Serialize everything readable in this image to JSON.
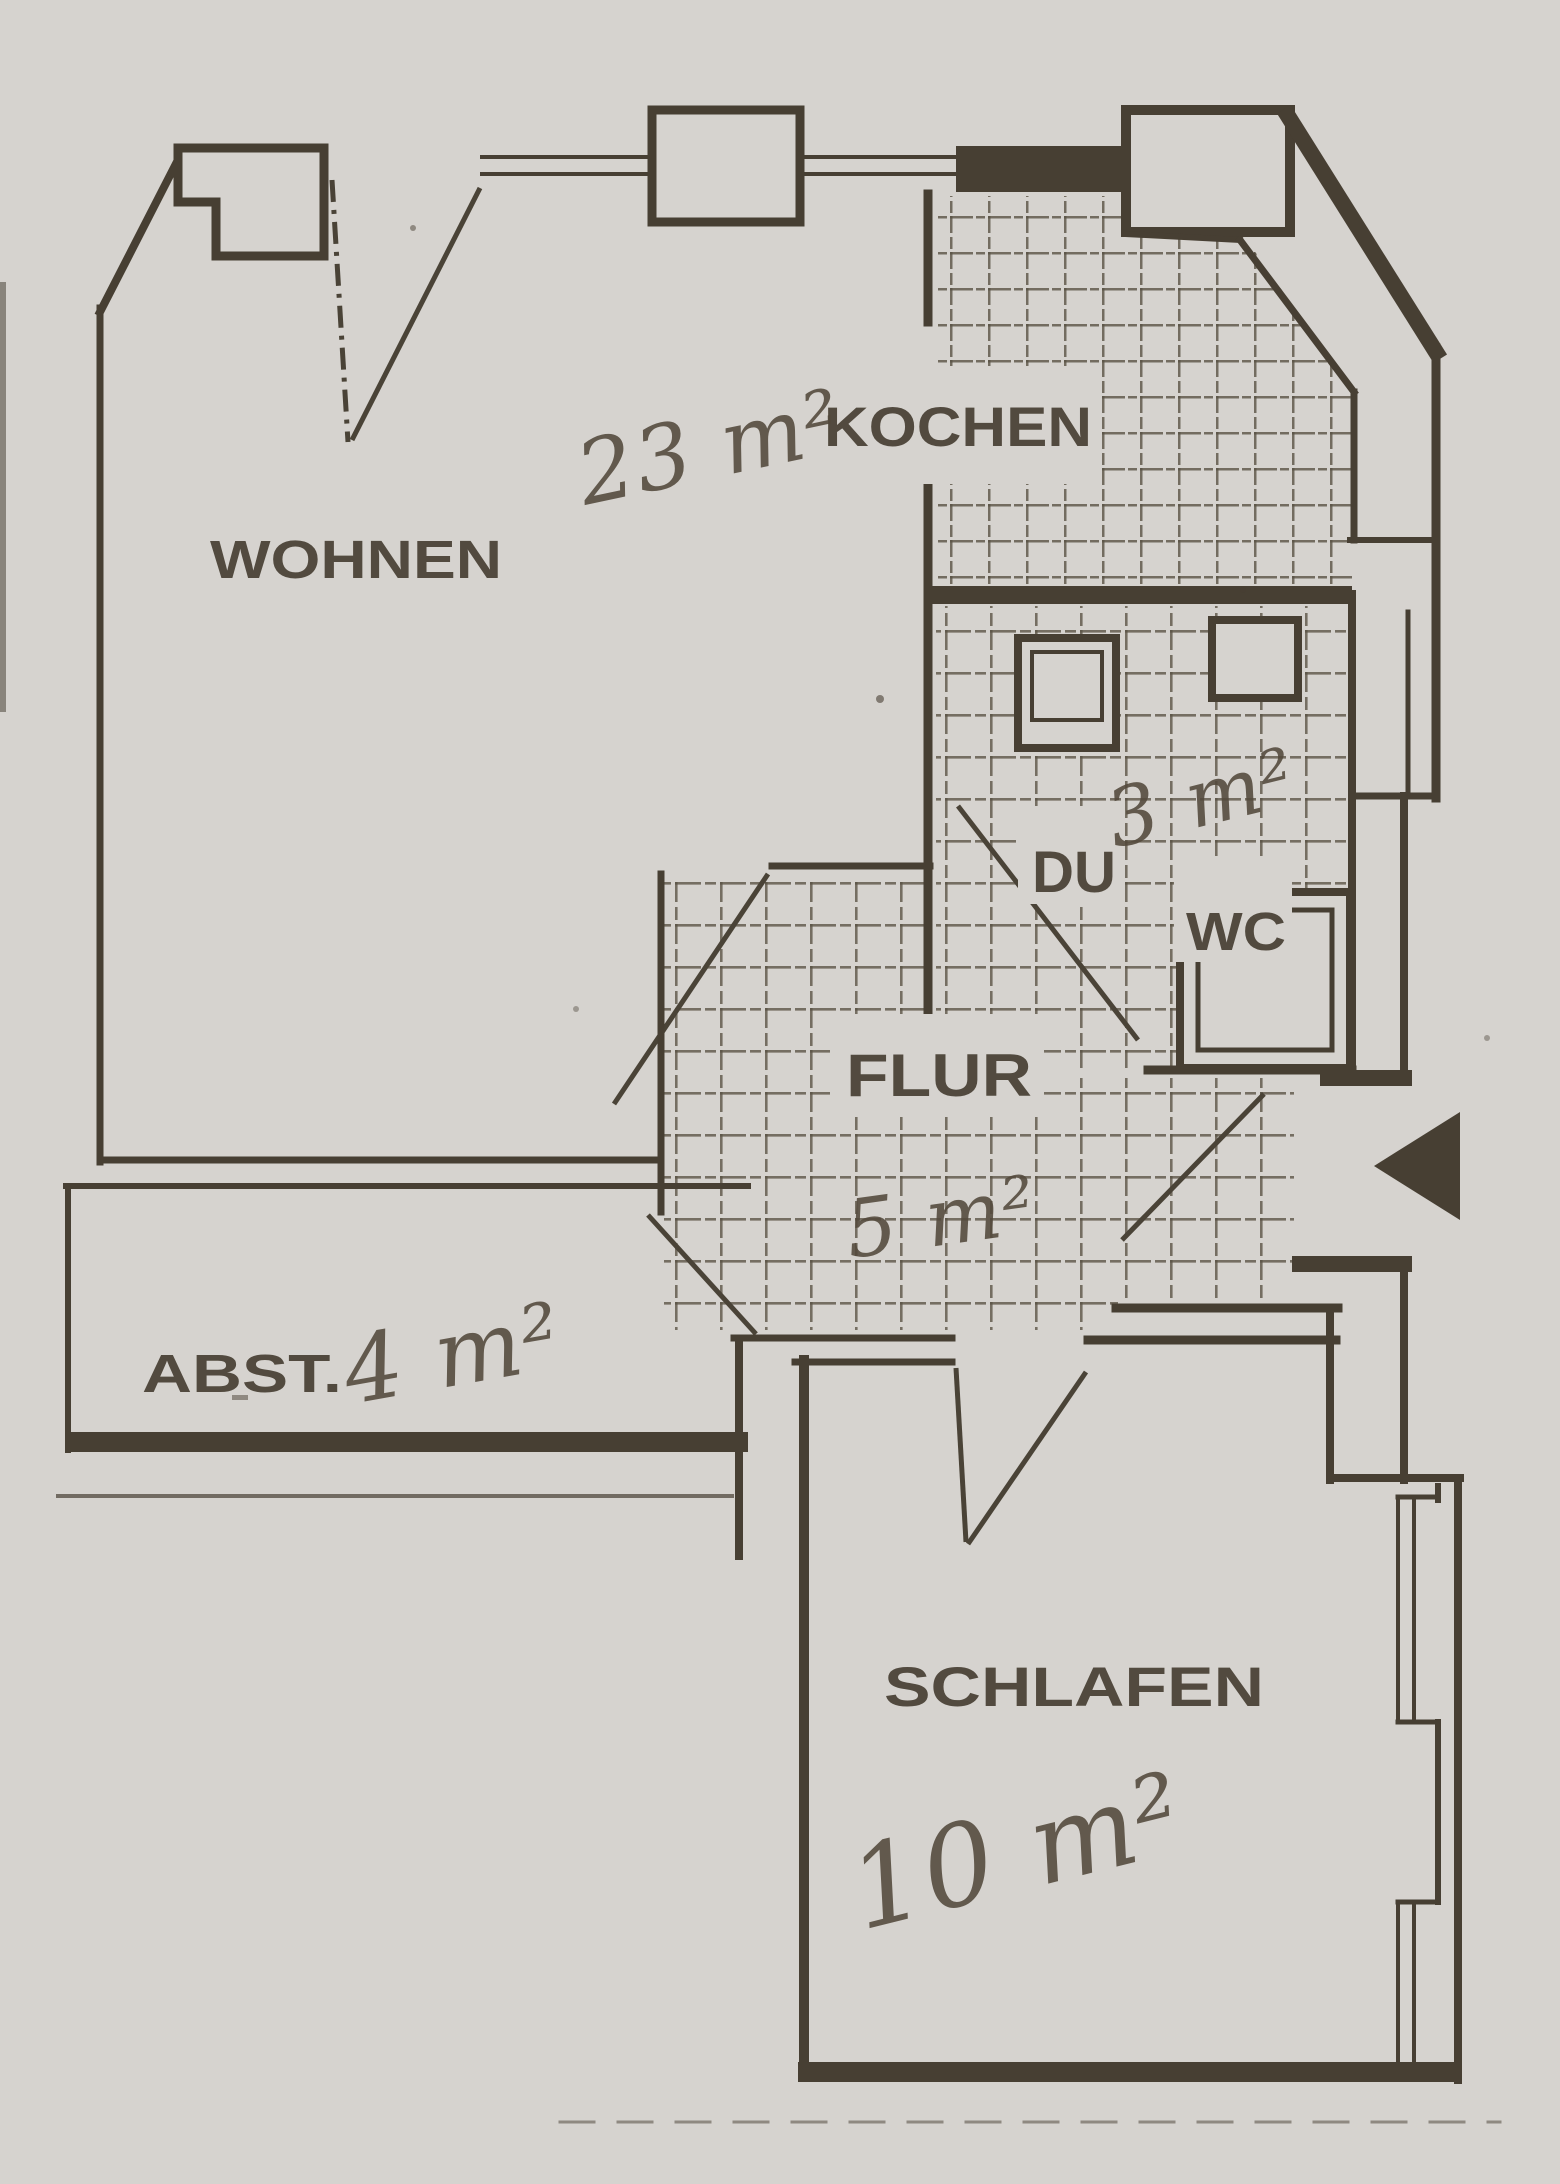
{
  "rooms": {
    "wohnen": {
      "label": "WOHNEN",
      "area": "23 m²"
    },
    "kochen": {
      "label": "KOCHEN"
    },
    "duwc": {
      "label_du": "DU",
      "label_wc": "WC",
      "area": "3 m²"
    },
    "flur": {
      "label": "FLUR",
      "area": "5 m²"
    },
    "abst": {
      "label": "ABST.",
      "area": "4 m²"
    },
    "schlafen": {
      "label": "SCHLAFEN",
      "area": "10 m²"
    }
  },
  "icons": {
    "entrance_arrow": "left-pointing-filled-triangle"
  },
  "colors": {
    "paper": "#d6d3cf",
    "ink": "#473f33",
    "handwriting": "#53493c",
    "tile_line": "#5a5244"
  }
}
